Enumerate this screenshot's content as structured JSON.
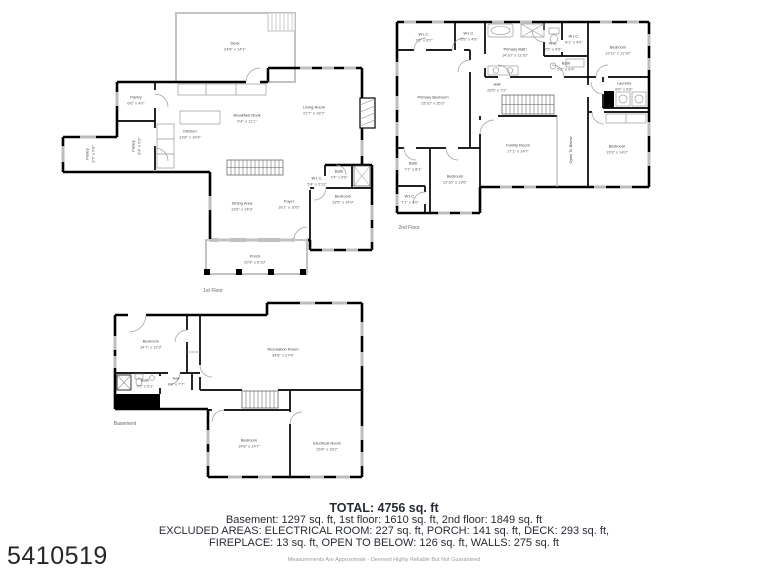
{
  "page": {
    "watermark_id": "5410519",
    "disclaimer": "Measurements Are Approximate - Deemed Highly Reliable But Not Guaranteed"
  },
  "summary": {
    "total": "TOTAL: 4756 sq. ft",
    "line1": "Basement: 1297 sq. ft, 1st floor: 1610 sq. ft, 2nd floor: 1849 sq. ft",
    "line2": "EXCLUDED AREAS: ELECTRICAL ROOM: 227 sq. ft, PORCH: 141 sq. ft, DECK: 293 sq. ft,",
    "line3": "FIREPLACE: 13 sq. ft, OPEN TO BELOW: 126 sq. ft, WALLS: 275 sq. ft"
  },
  "colors": {
    "walls": "#000000",
    "light_walls": "#c2c2c2",
    "text": "#262b33",
    "muted": "#9a9a9a"
  },
  "floors": [
    {
      "caption": "1st Floor",
      "rooms": [
        {
          "name": "Deck",
          "dims": "24'8\" x 14'1\""
        },
        {
          "name": "Pantry",
          "dims": "6'6\" x 4'0\""
        },
        {
          "name": "Pantry",
          "dims": "8'4\" x 5'0\""
        },
        {
          "name": "Pantry",
          "dims": "9'7\" x 5'8\""
        },
        {
          "name": "Kitchen",
          "dims": "13'8\" x 16'4\""
        },
        {
          "name": "Breakfast Nook",
          "dims": "9'4\" x 11'1\""
        },
        {
          "name": "Living Room",
          "dims": "21'7\" x 18'7\""
        },
        {
          "name": "Dining Area",
          "dims": "13'6\" x 14'3\""
        },
        {
          "name": "Foyer",
          "dims": "16'1\" x 10'6\""
        },
        {
          "name": "Bath",
          "dims": "7'4\" x 5'6\""
        },
        {
          "name": "W.I.C.",
          "dims": "5'4\" x 2'11\""
        },
        {
          "name": "Bedroom",
          "dims": "13'5\" x 14'9\""
        },
        {
          "name": "Porch",
          "dims": "20'9\" x 6'10\""
        }
      ]
    },
    {
      "caption": "2nd Floor",
      "rooms": [
        {
          "name": "W.I.C.",
          "dims": "7'6\" x 6'2\""
        },
        {
          "name": "W.I.C.",
          "dims": "6'5\" x 4'6\""
        },
        {
          "name": "Primary Bath",
          "dims": "14'10\" x 11'10\""
        },
        {
          "name": "W.C.",
          "dims": "3'5\" x 4'6\""
        },
        {
          "name": "W.I.C.",
          "dims": "8'1\" x 4'0\""
        },
        {
          "name": "Bath",
          "dims": "5'2\" x 9'4\""
        },
        {
          "name": "Bedroom",
          "dims": "12'11\" x 11'10\""
        },
        {
          "name": "Laundry",
          "dims": "8'0\" x 6'8\""
        },
        {
          "name": "Primary Bedroom",
          "dims": "15'10\" x 26'3\""
        },
        {
          "name": "Hall",
          "dims": "28'5\" x 7'2\""
        },
        {
          "name": "Family Room",
          "dims": "17'1\" x 14'7\""
        },
        {
          "name": "Open To Below",
          "dims": ""
        },
        {
          "name": "Bath",
          "dims": "7'1\" x 8'1\""
        },
        {
          "name": "Bedroom",
          "dims": "12'10\" x 13'6\""
        },
        {
          "name": "W.I.C.",
          "dims": "7'1\" x 3'0\""
        },
        {
          "name": "Bedroom",
          "dims": "13'9\" x 14'2\""
        }
      ]
    },
    {
      "caption": "Basement",
      "rooms": [
        {
          "name": "Bedroom",
          "dims": "14'7\" x 12'3\""
        },
        {
          "name": "Recreation Room",
          "dims": "34'8\" x 27'4\""
        },
        {
          "name": "Bath",
          "dims": "7'0\" x 5'1\""
        },
        {
          "name": "Hall",
          "dims": "7'9\" x 7'7\""
        },
        {
          "name": "Bedroom",
          "dims": "14'8\" x 14'7\""
        },
        {
          "name": "Electrical Room",
          "dims": "15'8\" x 18'2\""
        }
      ]
    }
  ]
}
